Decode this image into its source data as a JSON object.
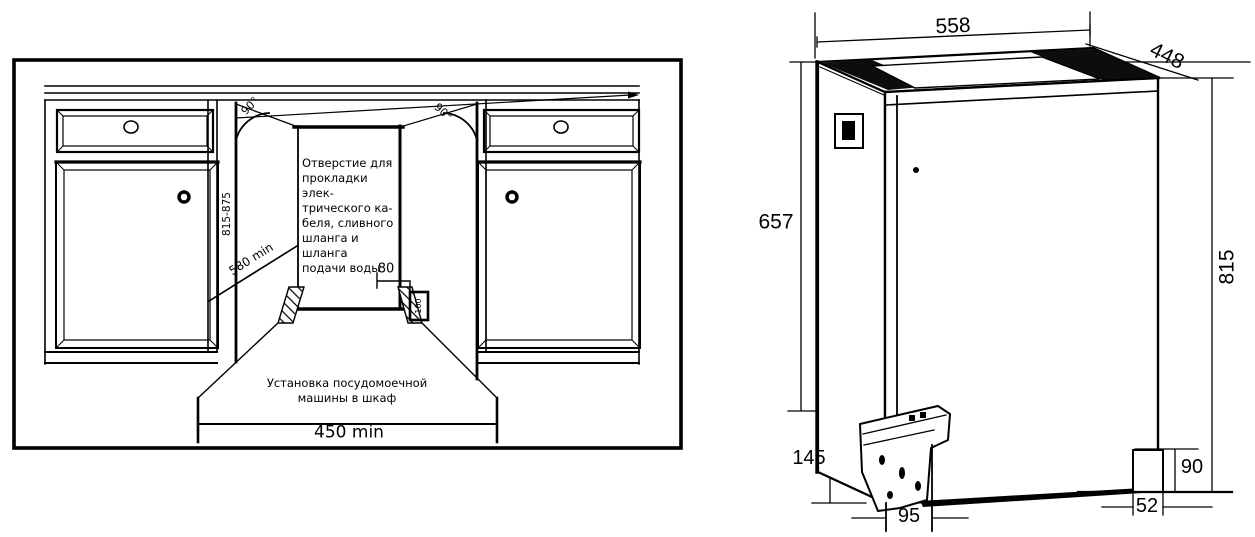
{
  "page": {
    "background": "#ffffff",
    "line_color": "#000000"
  },
  "left_diagram": {
    "hole_note": "Отверстие для\nпрокладки элек-\nтрического ка-\nбеля, сливного\nшланга и шланга\nподачи воды",
    "caption": "Установка посудомоечной\nмашины в шкаф",
    "dimensions": {
      "niche_width_min": "450 min",
      "niche_depth_min": "580 min",
      "niche_height_range": "815-875",
      "hole_width": "80",
      "hole_height": "100",
      "angle_left": "90°",
      "angle_right": "90°"
    }
  },
  "right_diagram": {
    "dimensions": {
      "width": "558",
      "depth": "448",
      "height_body": "657",
      "height_total": "815",
      "base_height": "145",
      "rear_foot_height": "90",
      "front_foot_offset": "95",
      "rear_foot_offset": "52"
    }
  }
}
